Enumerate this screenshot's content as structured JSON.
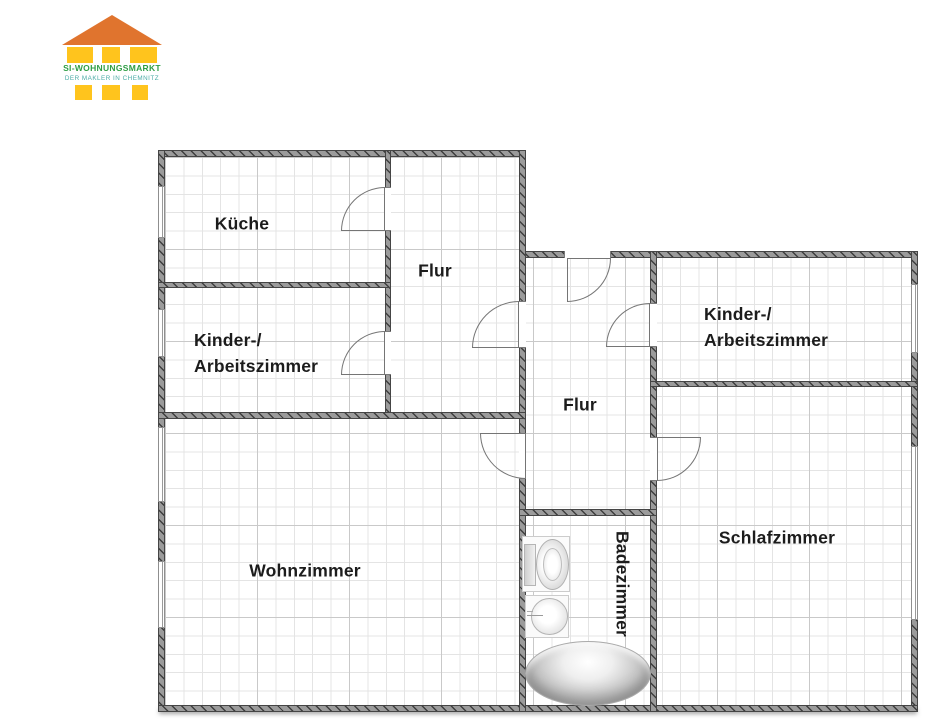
{
  "logo": {
    "brand": "SI-WOHNUNGSMARKT",
    "tagline": "DER MAKLER IN CHEMNITZ",
    "colors": {
      "roof": "#E0742E",
      "body": "#FFC41D",
      "brand_text": "#2F9E45",
      "tagline_text": "#4AABA5"
    }
  },
  "floorplan": {
    "rooms": {
      "kueche": {
        "label": "Küche"
      },
      "flur_left": {
        "label": "Flur"
      },
      "kinder_left": {
        "line1": "Kinder-/",
        "line2": "Arbeitszimmer"
      },
      "wohnzimmer": {
        "label": "Wohnzimmer"
      },
      "flur_middle": {
        "label": "Flur"
      },
      "badezimmer": {
        "label": "Badezimmer"
      },
      "kinder_right": {
        "line1": "Kinder-/",
        "line2": "Arbeitszimmer"
      },
      "schlafzimmer": {
        "label": "Schlafzimmer"
      }
    },
    "fixtures": {
      "toilet": "toilet",
      "sink": "sink",
      "bathtub": "bathtub"
    },
    "style": {
      "wall_color": "#9b9b9b",
      "wall_hatch_color": "#3e3e3e",
      "grid_minor_color": "#e4e4e4",
      "grid_major_color": "#c9c9c9",
      "label_color": "#1c1c1c"
    }
  }
}
